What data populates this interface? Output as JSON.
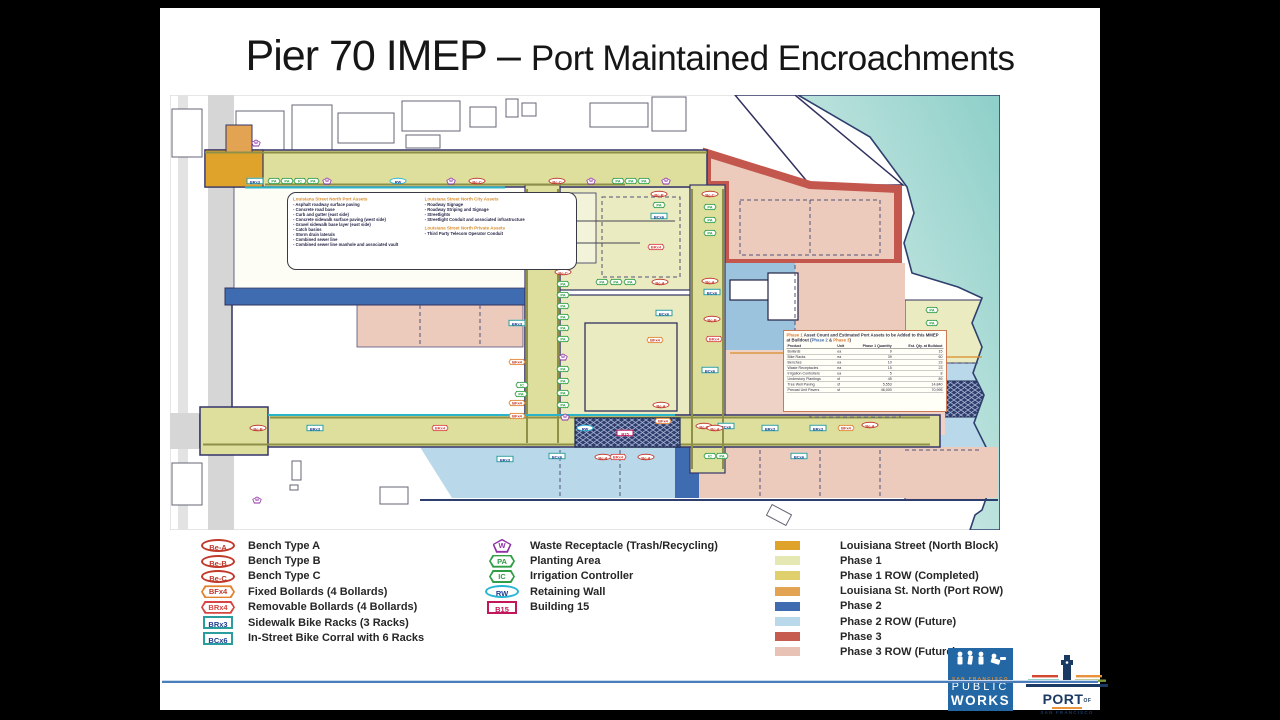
{
  "slide": {
    "title_main": "Pier 70 IMEP – ",
    "title_sub": "Port Maintained Encroachments"
  },
  "callouts": {
    "port": {
      "title": "Louisiana Street North Port Assets",
      "items": [
        "Asphalt roadway surface paving",
        "Concrete road base",
        "Curb and gutter (east side)",
        "Concrete sidewalk surface paving (west side)",
        "Gravel sidewalk base layer (east side)",
        "Catch basins",
        "Storm drain laterals",
        "Combined sewer line",
        "Combined sewer line manhole and associated vault"
      ]
    },
    "city": {
      "title": "Louisiana Street North City Assets",
      "items": [
        "Roadway Signage",
        "Roadway Striping and Signage",
        "Streetlights",
        "Streetlight Conduit and associated infrastructure"
      ]
    },
    "private": {
      "title": "Louisiana Street North Private Assets",
      "items": [
        "Third Party Telecom Operator Conduit"
      ]
    }
  },
  "asset_table": {
    "title_phase1": "Phase 1",
    "title_body": " Asset Count and Estimated Port Assets to be Added to this MMEP at Buildout (",
    "title_phase2": "Phase 2",
    "title_amp": " & ",
    "title_phase3": "Phase 3",
    "title_close": ")",
    "columns": [
      "Product",
      "Unit",
      "Phase 1 Quantity",
      "Est. Qty. at Buildout"
    ],
    "rows": [
      [
        "Bollards",
        "ea",
        "9",
        "15"
      ],
      [
        "Bike Racks",
        "ea",
        "39",
        "60"
      ],
      [
        "Benches",
        "ea",
        "10",
        "23"
      ],
      [
        "Waste Receptacles",
        "ea",
        "15",
        "23"
      ],
      [
        "Irrigation Controllers",
        "ea",
        "5",
        "8"
      ],
      [
        "Understory Plantings",
        "sf",
        "45",
        "89"
      ],
      [
        "Tree Well Paving",
        "sf",
        "5,553",
        "14,840"
      ],
      [
        "Precast Unit Pavers",
        "sf",
        "46,000",
        "70,995"
      ]
    ]
  },
  "marker_styles": {
    "be": {
      "shape": "oval",
      "color": "#c0392b"
    },
    "bf": {
      "shape": "hex",
      "color": "#e2812e",
      "tcolor": "#c0392b"
    },
    "br": {
      "shape": "hex",
      "color": "#d64541"
    },
    "rk": {
      "shape": "rect",
      "color": "#2a9d9f",
      "tcolor": "#1d3f8f"
    },
    "w": {
      "shape": "pent",
      "color": "#8e2fa5"
    },
    "pa": {
      "shape": "hexs",
      "color": "#2f9e44"
    },
    "rw": {
      "shape": "oval",
      "color": "#26b6d4",
      "tcolor": "#1d3f8f"
    },
    "b15": {
      "shape": "rect",
      "color": "#c2185b"
    }
  },
  "legend": {
    "markers_col1": [
      {
        "code": "Be-A",
        "kind": "be",
        "label": "Bench Type A"
      },
      {
        "code": "Be-B",
        "kind": "be",
        "label": "Bench Type B"
      },
      {
        "code": "Be-C",
        "kind": "be",
        "label": "Bench Type C"
      },
      {
        "code": "BFx4",
        "kind": "bf",
        "label": "Fixed Bollards (4 Bollards)"
      },
      {
        "code": "BRx4",
        "kind": "br",
        "label": "Removable Bollards (4 Bollards)"
      },
      {
        "code": "BRx3",
        "kind": "rk",
        "label": "Sidewalk Bike Racks (3 Racks)"
      },
      {
        "code": "BCx6",
        "kind": "rk",
        "label": "In-Street Bike Corral with 6 Racks"
      }
    ],
    "markers_col2": [
      {
        "code": "W",
        "kind": "w",
        "label": "Waste Receptacle (Trash/Recycling)"
      },
      {
        "code": "PA",
        "kind": "pa",
        "label": "Planting Area"
      },
      {
        "code": "IC",
        "kind": "pa",
        "label": "Irrigation Controller"
      },
      {
        "code": "RW",
        "kind": "rw",
        "label": "Retaining Wall"
      },
      {
        "code": "B15",
        "kind": "b15",
        "label": "Building 15"
      }
    ],
    "areas": [
      {
        "color": "#dfa32b",
        "label": "Louisiana Street (North Block)"
      },
      {
        "color": "#e6e8b4",
        "label": "Phase 1"
      },
      {
        "color": "#e0cf6d",
        "label": "Phase 1 ROW (Completed)"
      },
      {
        "color": "#e2a353",
        "label": "Louisiana St. North (Port ROW)"
      },
      {
        "color": "#3f6cb0",
        "label": "Phase 2"
      },
      {
        "color": "#b9d8e9",
        "label": "Phase 2 ROW (Future)"
      },
      {
        "color": "#c65b50",
        "label": "Phase 3"
      },
      {
        "color": "#e8c3b5",
        "label": "Phase 3 ROW (Future)"
      }
    ]
  },
  "map": {
    "markers": [
      {
        "c": "BRx3",
        "k": "rk",
        "x": 85,
        "y": 86
      },
      {
        "c": "PA",
        "k": "pa",
        "x": 104,
        "y": 86
      },
      {
        "c": "PA",
        "k": "pa",
        "x": 117,
        "y": 86
      },
      {
        "c": "IC",
        "k": "pa",
        "x": 130,
        "y": 86
      },
      {
        "c": "PA",
        "k": "pa",
        "x": 143,
        "y": 86
      },
      {
        "c": "W",
        "k": "w",
        "x": 157,
        "y": 86
      },
      {
        "c": "RW",
        "k": "rw",
        "x": 228,
        "y": 86
      },
      {
        "c": "W",
        "k": "w",
        "x": 281,
        "y": 86
      },
      {
        "c": "Be-C",
        "k": "be",
        "x": 307,
        "y": 86
      },
      {
        "c": "Be-C",
        "k": "be",
        "x": 387,
        "y": 86
      },
      {
        "c": "W",
        "k": "w",
        "x": 421,
        "y": 86
      },
      {
        "c": "PA",
        "k": "pa",
        "x": 448,
        "y": 86
      },
      {
        "c": "PA",
        "k": "pa",
        "x": 461,
        "y": 86
      },
      {
        "c": "PA",
        "k": "pa",
        "x": 474,
        "y": 86
      },
      {
        "c": "W",
        "k": "w",
        "x": 496,
        "y": 86
      },
      {
        "c": "W",
        "k": "w",
        "x": 86,
        "y": 48
      },
      {
        "c": "Be-C",
        "k": "be",
        "x": 540,
        "y": 99
      },
      {
        "c": "PA",
        "k": "pa",
        "x": 540,
        "y": 112
      },
      {
        "c": "PA",
        "k": "pa",
        "x": 540,
        "y": 125
      },
      {
        "c": "PA",
        "k": "pa",
        "x": 540,
        "y": 138
      },
      {
        "c": "Be-A",
        "k": "be",
        "x": 540,
        "y": 186
      },
      {
        "c": "BCx6",
        "k": "rk",
        "x": 542,
        "y": 197
      },
      {
        "c": "Be-B",
        "k": "be",
        "x": 542,
        "y": 224
      },
      {
        "c": "BRx4",
        "k": "br",
        "x": 544,
        "y": 244
      },
      {
        "c": "BCx6",
        "k": "rk",
        "x": 540,
        "y": 275
      },
      {
        "c": "Be-C",
        "k": "be",
        "x": 534,
        "y": 331
      },
      {
        "c": "BCx6",
        "k": "rk",
        "x": 556,
        "y": 331
      },
      {
        "c": "Be-B",
        "k": "be",
        "x": 489,
        "y": 99
      },
      {
        "c": "PA",
        "k": "pa",
        "x": 489,
        "y": 110
      },
      {
        "c": "BCx6",
        "k": "rk",
        "x": 489,
        "y": 121
      },
      {
        "c": "BRx4",
        "k": "br",
        "x": 486,
        "y": 152
      },
      {
        "c": "Be-C",
        "k": "be",
        "x": 393,
        "y": 177
      },
      {
        "c": "PA",
        "k": "pa",
        "x": 393,
        "y": 189
      },
      {
        "c": "PA",
        "k": "pa",
        "x": 393,
        "y": 200
      },
      {
        "c": "PA",
        "k": "pa",
        "x": 393,
        "y": 211
      },
      {
        "c": "PA",
        "k": "pa",
        "x": 393,
        "y": 222
      },
      {
        "c": "PA",
        "k": "pa",
        "x": 393,
        "y": 233
      },
      {
        "c": "PA",
        "k": "pa",
        "x": 393,
        "y": 244
      },
      {
        "c": "W",
        "k": "w",
        "x": 393,
        "y": 262
      },
      {
        "c": "PA",
        "k": "pa",
        "x": 393,
        "y": 274
      },
      {
        "c": "PA",
        "k": "pa",
        "x": 393,
        "y": 286
      },
      {
        "c": "PA",
        "k": "pa",
        "x": 393,
        "y": 298
      },
      {
        "c": "PA",
        "k": "pa",
        "x": 393,
        "y": 310
      },
      {
        "c": "W",
        "k": "w",
        "x": 395,
        "y": 322
      },
      {
        "c": "PA",
        "k": "pa",
        "x": 432,
        "y": 187
      },
      {
        "c": "PA",
        "k": "pa",
        "x": 446,
        "y": 187
      },
      {
        "c": "PA",
        "k": "pa",
        "x": 460,
        "y": 187
      },
      {
        "c": "Be-A",
        "k": "be",
        "x": 490,
        "y": 187
      },
      {
        "c": "BCx6",
        "k": "rk",
        "x": 494,
        "y": 218
      },
      {
        "c": "BFx4",
        "k": "bf",
        "x": 485,
        "y": 245
      },
      {
        "c": "Be-A",
        "k": "be",
        "x": 491,
        "y": 310
      },
      {
        "c": "BFx4",
        "k": "bf",
        "x": 493,
        "y": 326
      },
      {
        "c": "BRx3",
        "k": "rk",
        "x": 347,
        "y": 228
      },
      {
        "c": "BFx4",
        "k": "bf",
        "x": 347,
        "y": 267
      },
      {
        "c": "IC",
        "k": "pa",
        "x": 352,
        "y": 290
      },
      {
        "c": "PA",
        "k": "pa",
        "x": 351,
        "y": 299
      },
      {
        "c": "BFx4",
        "k": "bf",
        "x": 347,
        "y": 308
      },
      {
        "c": "BFx4",
        "k": "bf",
        "x": 347,
        "y": 321
      },
      {
        "c": "Be-B",
        "k": "be",
        "x": 88,
        "y": 333
      },
      {
        "c": "BRx3",
        "k": "rk",
        "x": 145,
        "y": 333
      },
      {
        "c": "BRx4",
        "k": "br",
        "x": 270,
        "y": 333
      },
      {
        "c": "RW",
        "k": "rw",
        "x": 415,
        "y": 333
      },
      {
        "c": "Be-A",
        "k": "be",
        "x": 545,
        "y": 333
      },
      {
        "c": "BRx3",
        "k": "rk",
        "x": 600,
        "y": 333
      },
      {
        "c": "BRx3",
        "k": "rk",
        "x": 648,
        "y": 333
      },
      {
        "c": "BFx4",
        "k": "bf",
        "x": 676,
        "y": 333
      },
      {
        "c": "Be-A",
        "k": "be",
        "x": 700,
        "y": 330
      },
      {
        "c": "BRx3",
        "k": "rk",
        "x": 335,
        "y": 364
      },
      {
        "c": "BCx6",
        "k": "rk",
        "x": 387,
        "y": 361
      },
      {
        "c": "Be-A",
        "k": "be",
        "x": 433,
        "y": 362
      },
      {
        "c": "BRx4",
        "k": "br",
        "x": 448,
        "y": 362
      },
      {
        "c": "Be-A",
        "k": "be",
        "x": 476,
        "y": 362
      },
      {
        "c": "IC",
        "k": "pa",
        "x": 540,
        "y": 361
      },
      {
        "c": "PA",
        "k": "pa",
        "x": 552,
        "y": 361
      },
      {
        "c": "BCx6",
        "k": "rk",
        "x": 629,
        "y": 361
      },
      {
        "c": "W",
        "k": "w",
        "x": 87,
        "y": 405
      },
      {
        "c": "B15",
        "k": "b15",
        "x": 455,
        "y": 338
      },
      {
        "c": "PA",
        "k": "pa",
        "x": 762,
        "y": 215
      },
      {
        "c": "PA",
        "k": "pa",
        "x": 762,
        "y": 228
      },
      {
        "c": "PA",
        "k": "pa",
        "x": 762,
        "y": 241
      },
      {
        "c": "W",
        "k": "w",
        "x": 764,
        "y": 258
      },
      {
        "c": "PA",
        "k": "pa",
        "x": 764,
        "y": 272
      },
      {
        "c": "PA",
        "k": "pa",
        "x": 764,
        "y": 285
      },
      {
        "c": "W",
        "k": "w",
        "x": 764,
        "y": 305
      }
    ]
  },
  "logos": {
    "public_works": {
      "city": "SAN FRANCISCO",
      "line1": "PUBLIC",
      "line2": "WORKS"
    },
    "port": {
      "name": "PORT",
      "of": "OF",
      "city": "SAN FRANCISCO"
    }
  }
}
